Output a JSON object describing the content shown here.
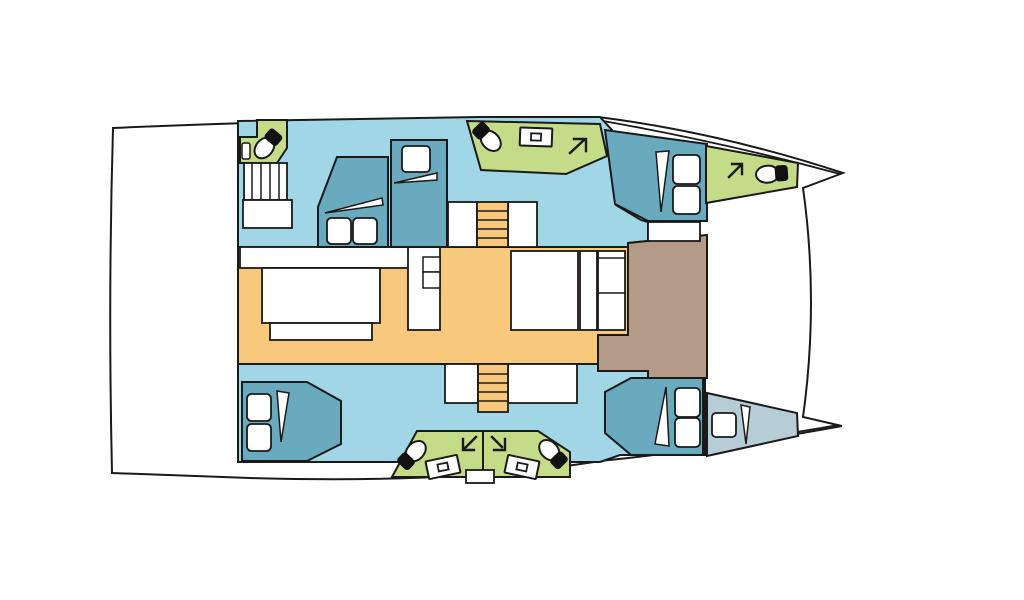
{
  "canvas": {
    "width": 1024,
    "height": 600,
    "background": "#ffffff"
  },
  "palette": {
    "outline": "#1a1a1a",
    "hull_white": "#ffffff",
    "cabin_floor": "#a0d6e5",
    "furniture_blue": "#6aaabf",
    "bathroom_green": "#c4db88",
    "saloon_orange": "#f8c87d",
    "cockpit_brown": "#b49b87",
    "bow_locker_gray": "#b6cdd5",
    "icon_black": "#111111"
  },
  "icons": {
    "toilet": "toilet-icon",
    "sink": "sink-icon",
    "companionway_arrow": "arrow-icon",
    "stairs": "stair-treads"
  }
}
